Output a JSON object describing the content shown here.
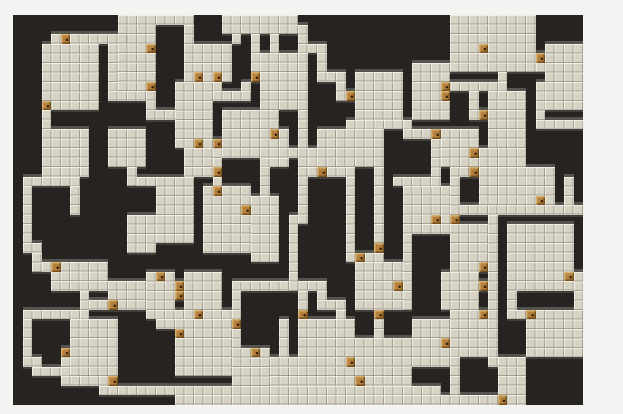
{
  "screen": {
    "type": "dungeon-map-view",
    "outer_background": "#f3f3f1"
  },
  "map": {
    "origin_x": 13,
    "origin_y": 15,
    "cols": 60,
    "rows": 41,
    "tile_size": 9.5,
    "colors": {
      "map_bg": "#262321",
      "floor_base": "#d6d3c5",
      "tile_highlight": "rgba(248,246,238,0.75)",
      "tile_shade": "rgba(110,107,96,0.50)",
      "wall_top": "#55544f",
      "wall_bottom": "#413f3b",
      "door": "#b5813c"
    },
    "rooms": [
      [
        3,
        3,
        6,
        7
      ],
      [
        11,
        0,
        4,
        8
      ],
      [
        18,
        3,
        5,
        4
      ],
      [
        17,
        7,
        4,
        7
      ],
      [
        26,
        4,
        5,
        6
      ],
      [
        22,
        10,
        6,
        5
      ],
      [
        36,
        6,
        5,
        5
      ],
      [
        32,
        12,
        7,
        4
      ],
      [
        42,
        5,
        4,
        6
      ],
      [
        46,
        0,
        4,
        6
      ],
      [
        50,
        0,
        5,
        6
      ],
      [
        56,
        3,
        4,
        7
      ],
      [
        50,
        8,
        4,
        6
      ],
      [
        45,
        12,
        4,
        4
      ],
      [
        49,
        14,
        5,
        6
      ],
      [
        54,
        16,
        3,
        4
      ],
      [
        41,
        18,
        5,
        4
      ],
      [
        46,
        22,
        4,
        5
      ],
      [
        52,
        22,
        7,
        7
      ],
      [
        15,
        17,
        4,
        7
      ],
      [
        20,
        18,
        5,
        7
      ],
      [
        25,
        19,
        3,
        7
      ],
      [
        3,
        12,
        5,
        5
      ],
      [
        10,
        12,
        4,
        4
      ],
      [
        12,
        21,
        3,
        4
      ],
      [
        14,
        27,
        2,
        5
      ],
      [
        4,
        26,
        6,
        3
      ],
      [
        10,
        28,
        4,
        3
      ],
      [
        18,
        27,
        4,
        4
      ],
      [
        6,
        32,
        5,
        6
      ],
      [
        17,
        32,
        6,
        6
      ],
      [
        23,
        35,
        4,
        6
      ],
      [
        27,
        36,
        4,
        4
      ],
      [
        30,
        32,
        6,
        7
      ],
      [
        36,
        34,
        6,
        5
      ],
      [
        36,
        26,
        5,
        5
      ],
      [
        42,
        32,
        4,
        5
      ],
      [
        45,
        27,
        4,
        4
      ],
      [
        46,
        31,
        4,
        5
      ],
      [
        54,
        31,
        6,
        5
      ],
      [
        51,
        36,
        3,
        5
      ],
      [
        18,
        14,
        3,
        3
      ]
    ],
    "corridors": [
      [
        4,
        2,
        8,
        1
      ],
      [
        15,
        0,
        4,
        1
      ],
      [
        18,
        1,
        1,
        2
      ],
      [
        22,
        0,
        4,
        2
      ],
      [
        23,
        2,
        1,
        1
      ],
      [
        25,
        2,
        1,
        5
      ],
      [
        26,
        0,
        4,
        2
      ],
      [
        27,
        2,
        1,
        2
      ],
      [
        10,
        3,
        1,
        5
      ],
      [
        10,
        8,
        5,
        1
      ],
      [
        14,
        8,
        1,
        2
      ],
      [
        14,
        10,
        3,
        1
      ],
      [
        21,
        7,
        1,
        1
      ],
      [
        21,
        8,
        4,
        1
      ],
      [
        24,
        7,
        1,
        1
      ],
      [
        30,
        10,
        1,
        12
      ],
      [
        28,
        12,
        1,
        2
      ],
      [
        28,
        14,
        4,
        1
      ],
      [
        26,
        15,
        3,
        1
      ],
      [
        26,
        16,
        1,
        3
      ],
      [
        31,
        14,
        1,
        2
      ],
      [
        31,
        16,
        5,
        1
      ],
      [
        35,
        17,
        1,
        8
      ],
      [
        35,
        25,
        4,
        1
      ],
      [
        38,
        16,
        1,
        9
      ],
      [
        30,
        1,
        1,
        3
      ],
      [
        30,
        3,
        3,
        1
      ],
      [
        32,
        4,
        1,
        2
      ],
      [
        32,
        6,
        3,
        1
      ],
      [
        34,
        7,
        1,
        2
      ],
      [
        35,
        8,
        1,
        1
      ],
      [
        35,
        11,
        6,
        1
      ],
      [
        41,
        11,
        1,
        2
      ],
      [
        41,
        12,
        4,
        1
      ],
      [
        44,
        13,
        1,
        4
      ],
      [
        40,
        17,
        5,
        1
      ],
      [
        41,
        22,
        5,
        1
      ],
      [
        41,
        23,
        1,
        8
      ],
      [
        45,
        7,
        7,
        1
      ],
      [
        45,
        8,
        1,
        1
      ],
      [
        51,
        6,
        1,
        1
      ],
      [
        48,
        8,
        1,
        3
      ],
      [
        49,
        10,
        1,
        1
      ],
      [
        55,
        4,
        1,
        2
      ],
      [
        55,
        7,
        1,
        4
      ],
      [
        55,
        11,
        5,
        1
      ],
      [
        58,
        17,
        1,
        3
      ],
      [
        46,
        20,
        14,
        1
      ],
      [
        46,
        16,
        3,
        1
      ],
      [
        46,
        17,
        1,
        4
      ],
      [
        46,
        21,
        1,
        1
      ],
      [
        50,
        21,
        1,
        15
      ],
      [
        50,
        36,
        1,
        1
      ],
      [
        49,
        28,
        1,
        1
      ],
      [
        49,
        31,
        1,
        1
      ],
      [
        52,
        28,
        1,
        3
      ],
      [
        52,
        31,
        2,
        1
      ],
      [
        59,
        27,
        1,
        4
      ],
      [
        21,
        13,
        1,
        5
      ],
      [
        1,
        17,
        6,
        1
      ],
      [
        1,
        18,
        1,
        7
      ],
      [
        6,
        18,
        1,
        3
      ],
      [
        1,
        24,
        2,
        1
      ],
      [
        2,
        25,
        1,
        2
      ],
      [
        3,
        26,
        1,
        1
      ],
      [
        3,
        10,
        1,
        2
      ],
      [
        12,
        16,
        1,
        2
      ],
      [
        13,
        17,
        2,
        1
      ],
      [
        7,
        29,
        1,
        2
      ],
      [
        8,
        30,
        2,
        1
      ],
      [
        1,
        31,
        7,
        1
      ],
      [
        1,
        32,
        1,
        4
      ],
      [
        1,
        36,
        2,
        1
      ],
      [
        2,
        37,
        3,
        1
      ],
      [
        5,
        35,
        1,
        3
      ],
      [
        5,
        38,
        6,
        1
      ],
      [
        9,
        39,
        36,
        1
      ],
      [
        17,
        40,
        37,
        1
      ],
      [
        14,
        31,
        2,
        1
      ],
      [
        16,
        27,
        1,
        5
      ],
      [
        17,
        28,
        1,
        2
      ],
      [
        16,
        31,
        8,
        1
      ],
      [
        23,
        28,
        10,
        1
      ],
      [
        23,
        29,
        1,
        6
      ],
      [
        29,
        21,
        1,
        8
      ],
      [
        30,
        29,
        1,
        3
      ],
      [
        32,
        29,
        1,
        2
      ],
      [
        32,
        30,
        3,
        1
      ],
      [
        34,
        31,
        1,
        1
      ],
      [
        28,
        32,
        1,
        4
      ],
      [
        38,
        31,
        1,
        3
      ],
      [
        15,
        32,
        2,
        1
      ],
      [
        46,
        36,
        1,
        4
      ]
    ],
    "doors": [
      [
        5,
        2
      ],
      [
        3,
        9
      ],
      [
        14,
        3
      ],
      [
        14,
        7
      ],
      [
        25,
        6
      ],
      [
        19,
        6
      ],
      [
        21,
        6
      ],
      [
        19,
        13
      ],
      [
        21,
        13
      ],
      [
        21,
        16
      ],
      [
        21,
        18
      ],
      [
        24,
        20
      ],
      [
        27,
        12
      ],
      [
        32,
        16
      ],
      [
        36,
        25
      ],
      [
        38,
        24
      ],
      [
        35,
        8
      ],
      [
        44,
        12
      ],
      [
        44,
        21
      ],
      [
        45,
        7
      ],
      [
        45,
        8
      ],
      [
        49,
        3
      ],
      [
        55,
        4
      ],
      [
        48,
        14
      ],
      [
        49,
        10
      ],
      [
        48,
        16
      ],
      [
        46,
        21
      ],
      [
        55,
        19
      ],
      [
        49,
        26
      ],
      [
        49,
        28
      ],
      [
        49,
        31
      ],
      [
        58,
        27
      ],
      [
        54,
        31
      ],
      [
        45,
        34
      ],
      [
        51,
        40
      ],
      [
        5,
        35
      ],
      [
        10,
        30
      ],
      [
        10,
        38
      ],
      [
        15,
        27
      ],
      [
        17,
        28
      ],
      [
        17,
        29
      ],
      [
        19,
        31
      ],
      [
        30,
        31
      ],
      [
        38,
        31
      ],
      [
        40,
        28
      ],
      [
        35,
        36
      ],
      [
        36,
        38
      ],
      [
        25,
        35
      ],
      [
        23,
        32
      ],
      [
        17,
        33
      ],
      [
        4,
        26
      ]
    ]
  }
}
